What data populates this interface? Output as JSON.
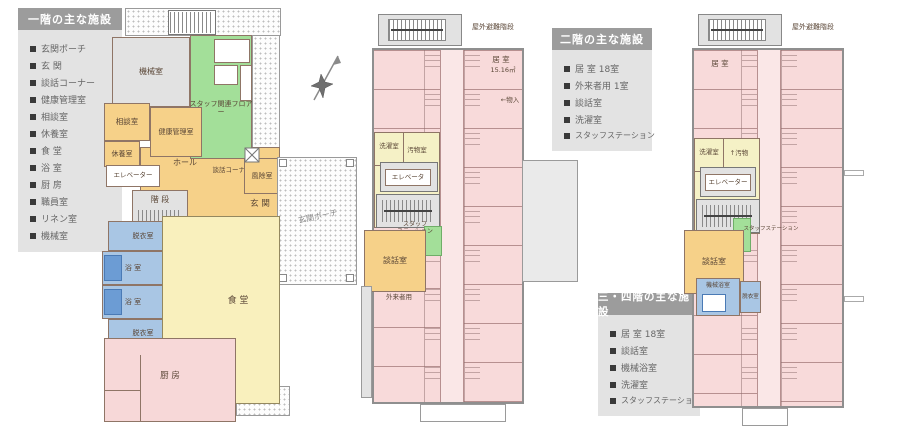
{
  "legend1": {
    "title": "一階の主な施設",
    "items": [
      "玄関ポーチ",
      "玄 関",
      "談話コーナー",
      "健康管理室",
      "相談室",
      "休養室",
      "食 堂",
      "浴 室",
      "厨 房",
      "職員室",
      "リネン室",
      "機械室"
    ]
  },
  "legend2": {
    "title": "二階の主な施設",
    "items": [
      "居 室 18室",
      "外来者用 1室",
      "談話室",
      "洗濯室",
      "スタッフステーション"
    ]
  },
  "legend3": {
    "title": "三・四階の主な施設",
    "items": [
      "居 室 18室",
      "談話室",
      "機械浴室",
      "洗濯室",
      "スタッフステーション"
    ]
  },
  "plan1": {
    "machine_room": "機械室",
    "staff_floor": "スタッフ関連フロアー",
    "consult_room": "相談室",
    "health_room": "健康管理室",
    "rest_room": "休養室",
    "elevator": "エレベーター",
    "hall": "ホール",
    "chat_corner": "談話コーナー",
    "windbreak": "風除室",
    "entrance": "玄 関",
    "stairs": "階 段",
    "porch": "玄関ポーチ",
    "dressing_upper": "脱衣室",
    "bath_upper": "浴 室",
    "bath_lower": "浴 室",
    "dressing_lower": "脱衣室",
    "wc_upper": "W.C",
    "wc_lower": "W.C",
    "dining": "食 堂",
    "kitchen": "厨 房"
  },
  "plan2": {
    "outdoor_stairs": "屋外避難階段",
    "room_label": "居 室",
    "room_area": "15.16㎡",
    "closet": "←物入",
    "laundry": "洗濯室",
    "soiled": "汚物室",
    "elevator": "エレベータ",
    "staff_station": "スタッフ\nステーション",
    "chat_room": "談話室",
    "visitor": "外来者用"
  },
  "plan3": {
    "outdoor_stairs": "屋外避難階段",
    "room_label": "居 室",
    "laundry": "洗濯室",
    "soiled": "↑汚物",
    "elevator": "エレベーター",
    "staff_station": "スタッフステーション",
    "chat_room": "談話室",
    "machine_bath": "機械浴室",
    "dressing": "脱衣室"
  }
}
